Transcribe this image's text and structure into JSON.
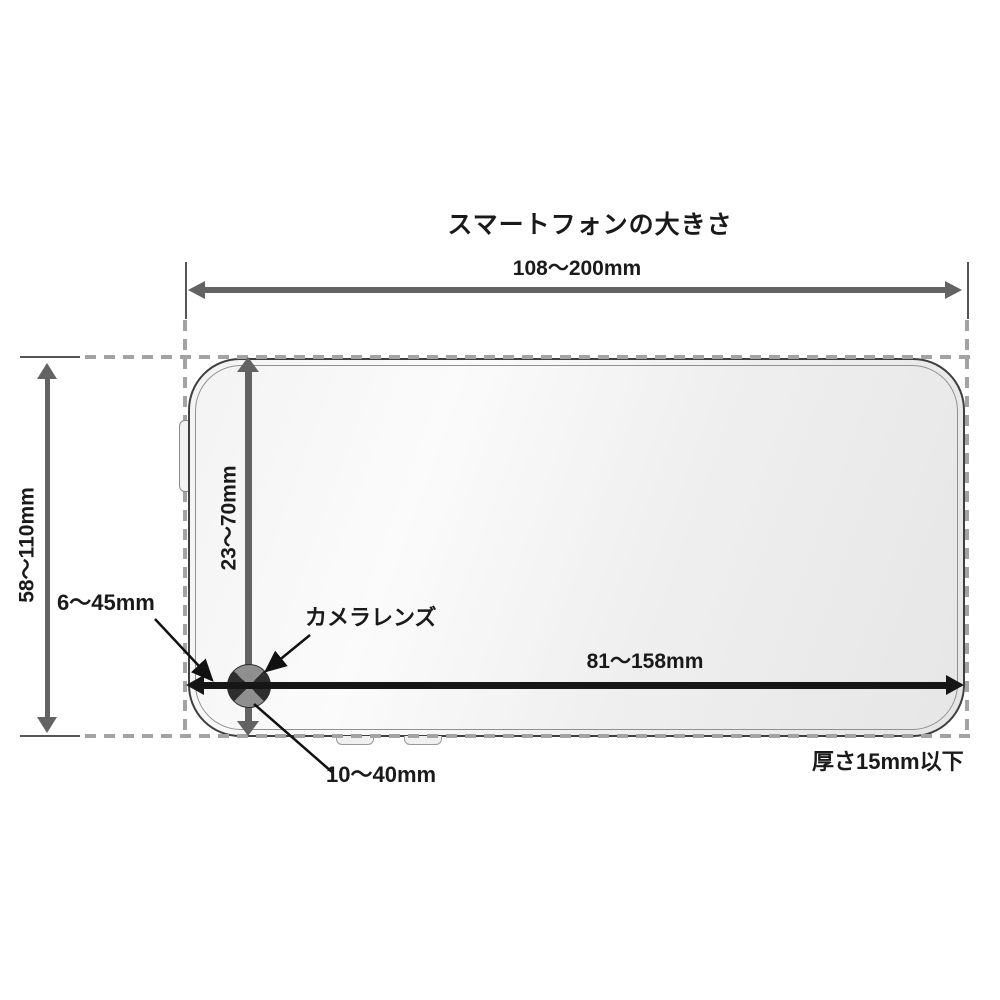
{
  "diagram": {
    "title": "スマートフォンの大きさ",
    "dimensions": {
      "width_range": "108〜200mm",
      "height_range": "58〜110mm",
      "lens_from_top": "23〜70mm",
      "lens_from_left": "6〜45mm",
      "lens_to_right_edge": "81〜158mm",
      "lens_from_bottom": "10〜40mm",
      "thickness_limit": "厚さ15mm以下"
    },
    "labels": {
      "camera_lens": "カメラレンズ"
    },
    "colors": {
      "background": "#ffffff",
      "gray_arrow": "#636363",
      "black_arrow": "#161616",
      "dashed_guide": "#a3a3a3",
      "text": "#1a1a1a",
      "phone_border": "#3f3f3f"
    }
  }
}
